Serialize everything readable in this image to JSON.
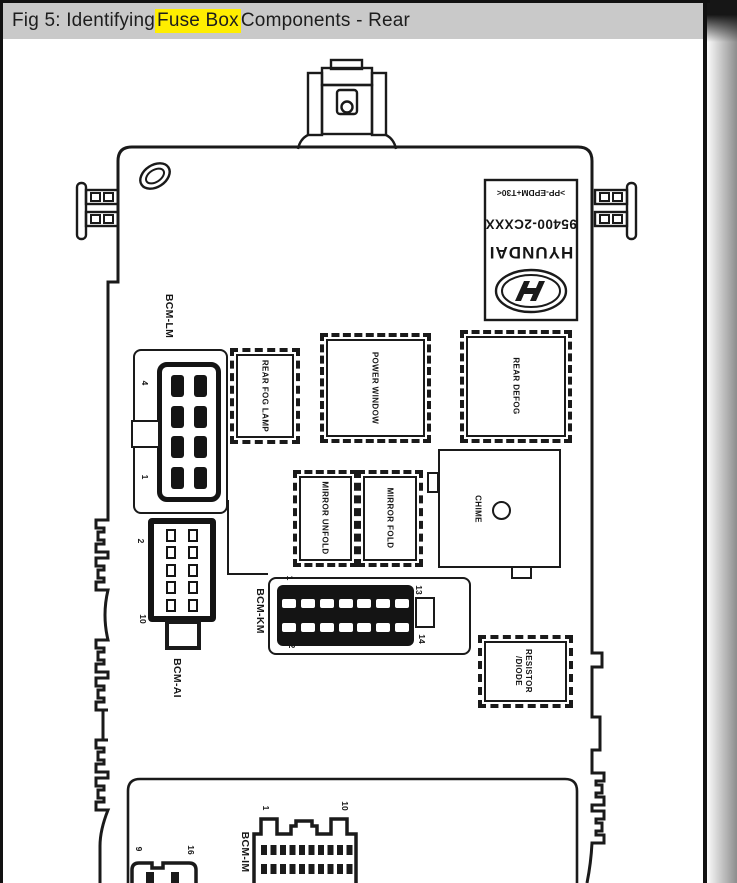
{
  "caption": {
    "prefix": "Fig 5: Identifying ",
    "highlight": "Fuse Box",
    "suffix": " Components - Rear"
  },
  "label_plate": {
    "material_code": ">PP-EPDM+T30<",
    "part_number": "95400-2CXXX",
    "brand": "HYUNDAI",
    "logo_icon": "hyundai-h-logo"
  },
  "relays": [
    {
      "label": "REAR FOG LAMP"
    },
    {
      "label": "POWER WINDOW"
    },
    {
      "label": "REAR DEFOG"
    },
    {
      "label": "MIRROR UNFOLD"
    },
    {
      "label": "MIRROR FOLD"
    }
  ],
  "resistor_diode": {
    "line1": "RESISTOR",
    "line2": "/DIODE"
  },
  "chime": {
    "label": "CHIME"
  },
  "connectors": {
    "bcm_lm": {
      "label": "BCM-LM",
      "pin_top": "4",
      "pin_bottom": "1"
    },
    "bcm_ai": {
      "label": "BCM-AI",
      "pin_top": "2",
      "pin_bottom": "10"
    },
    "bcm_km": {
      "label": "BCM-KM",
      "pin_top_left": "1",
      "pin_bottom_left": "2",
      "pin_top_right": "13",
      "pin_bottom_right": "14"
    },
    "bcm_im": {
      "label": "BCM-IM",
      "pin_left": "1",
      "pin_right": "10"
    },
    "aux": {
      "pin_left": "9",
      "pin_right": "16"
    }
  },
  "colors": {
    "highlight": "#ffee00",
    "title_bar": "#c9c9c9",
    "line": "#1a1a1a"
  }
}
